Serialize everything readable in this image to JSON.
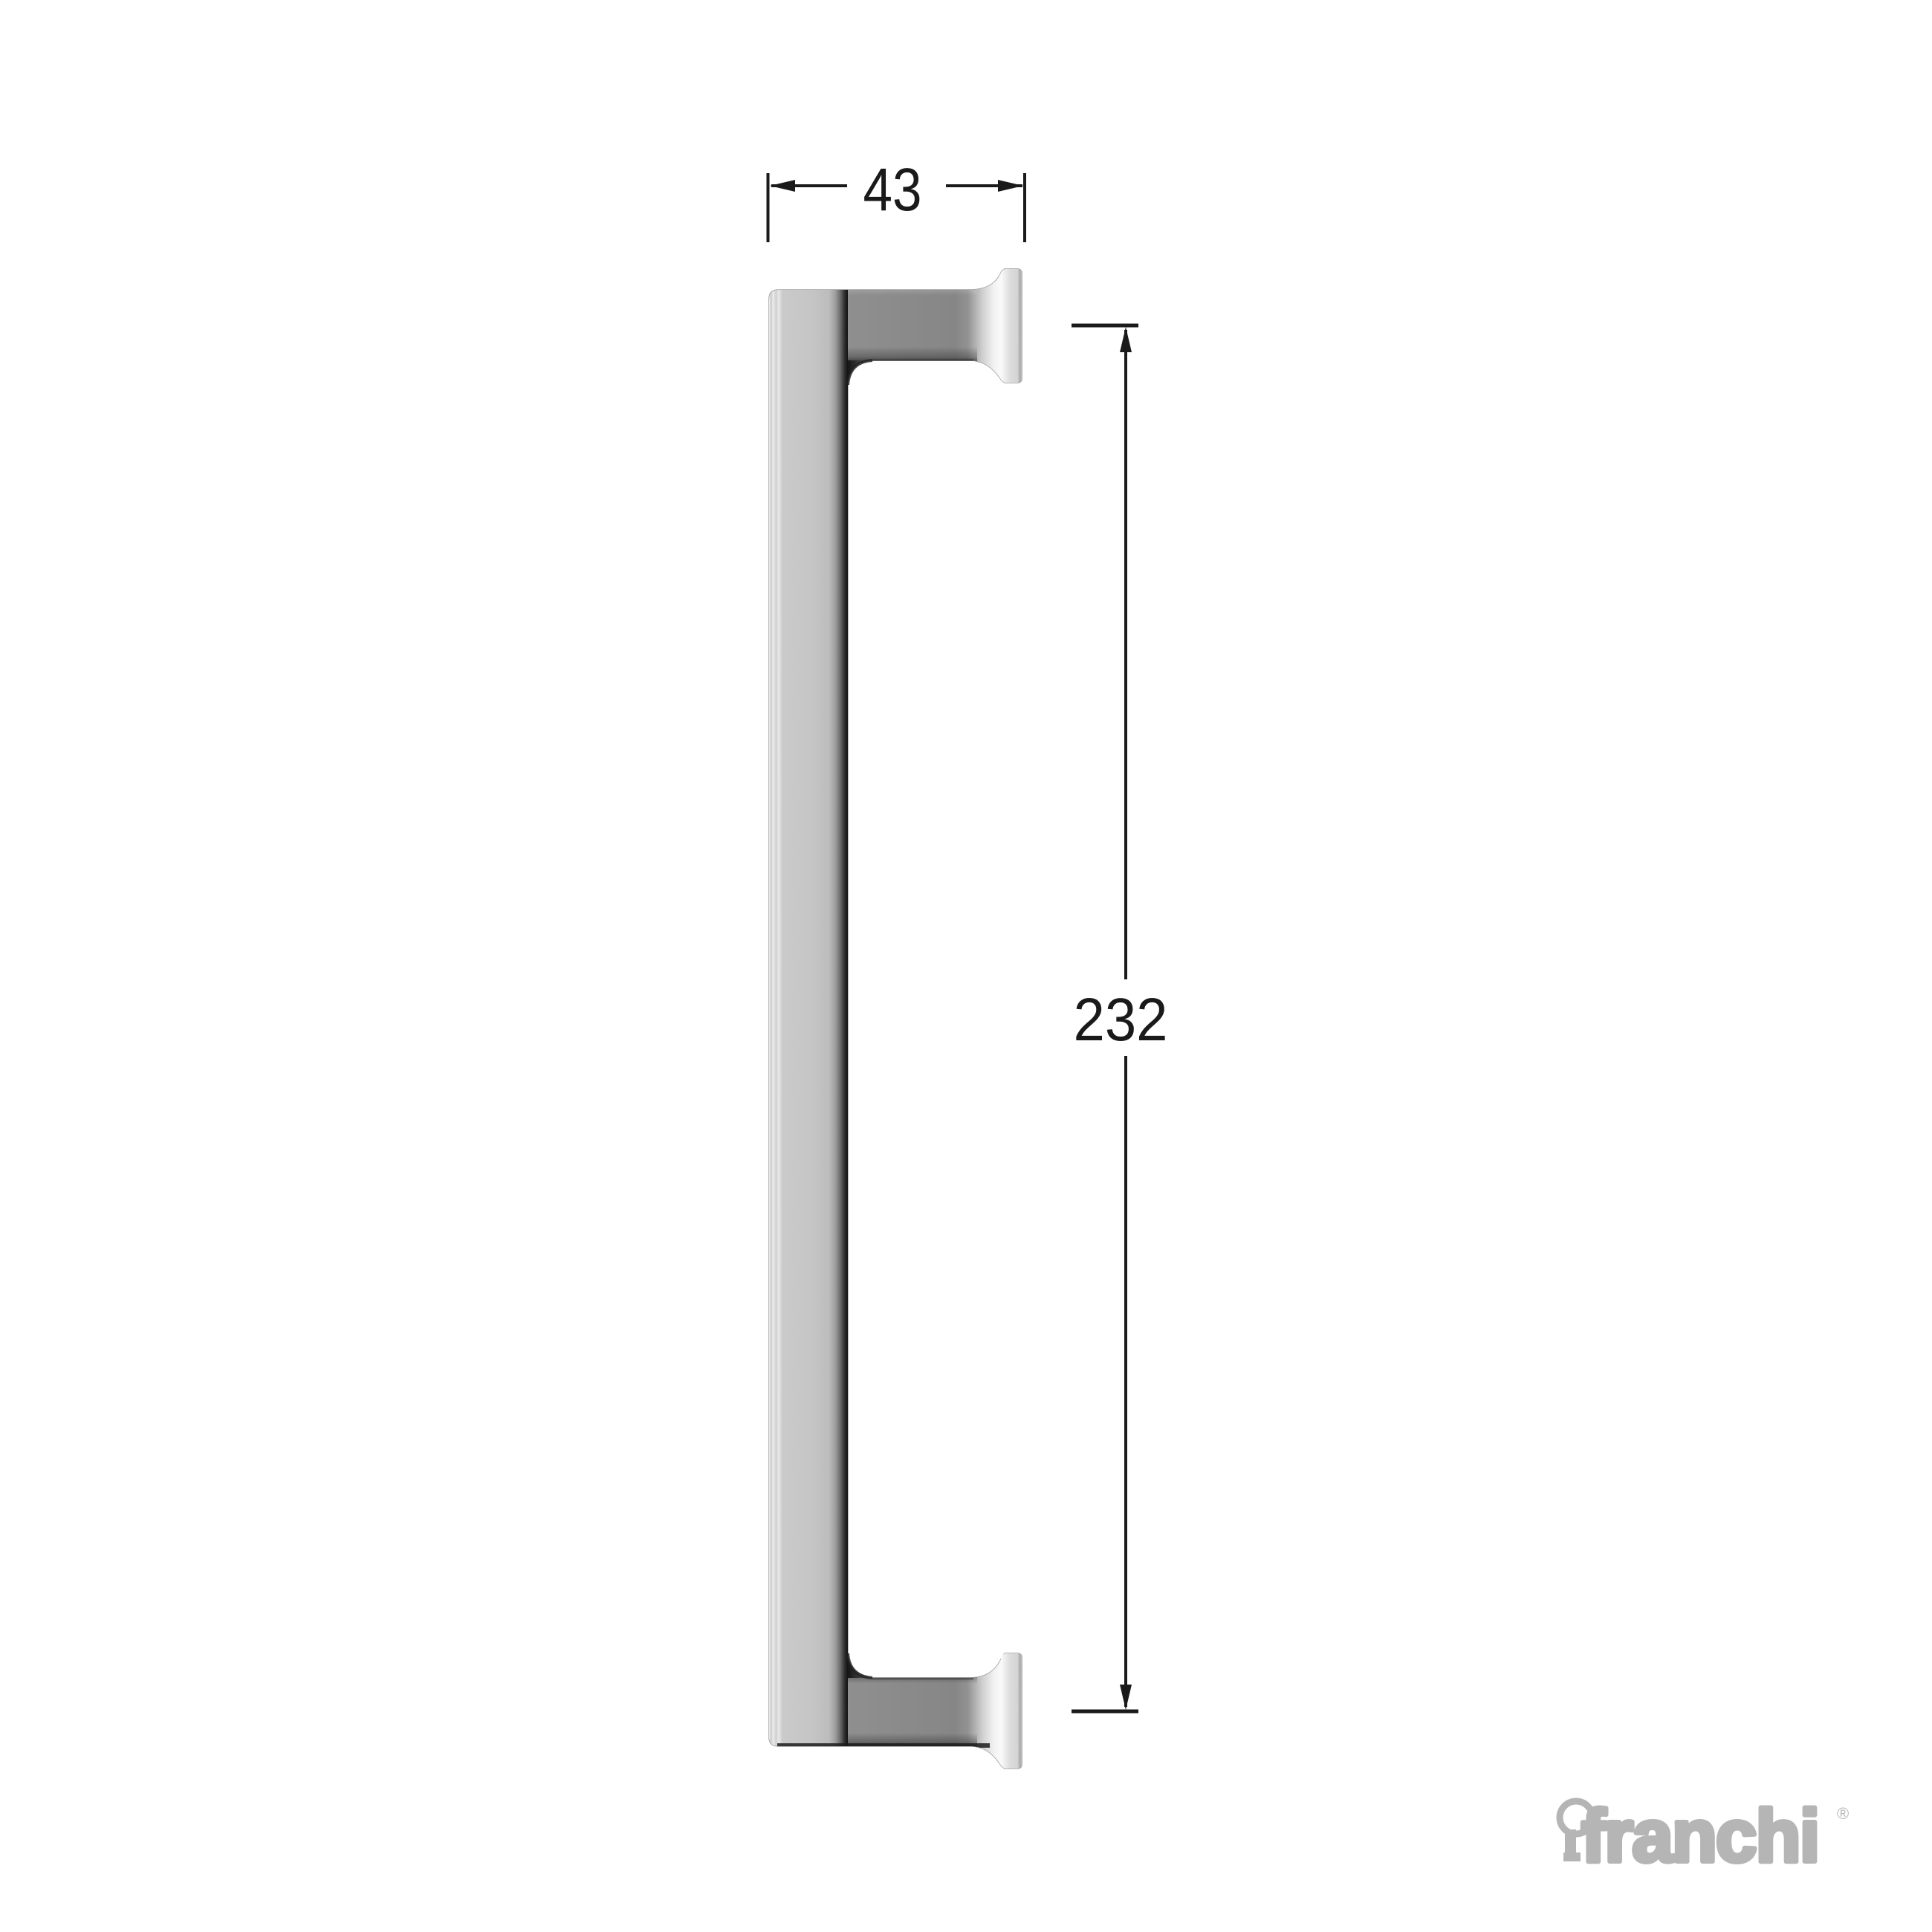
{
  "drawing": {
    "type": "technical dimension diagram",
    "subject": "door pull handle side profile",
    "dimensions": {
      "width_label": "43",
      "height_label": "232"
    },
    "colors": {
      "background": "#ffffff",
      "dimension_line": "#1a1a1a",
      "handle_face_light": "#c5c5c5",
      "handle_post_dark": "#878787",
      "handle_inner_edge": "#141414",
      "flange_light": "#d9d9d9"
    }
  },
  "branding": {
    "logo_icon": "keyhole-icon",
    "logo_text": "franchi",
    "registered_mark": "®",
    "logo_color": "#b5b5b5"
  }
}
